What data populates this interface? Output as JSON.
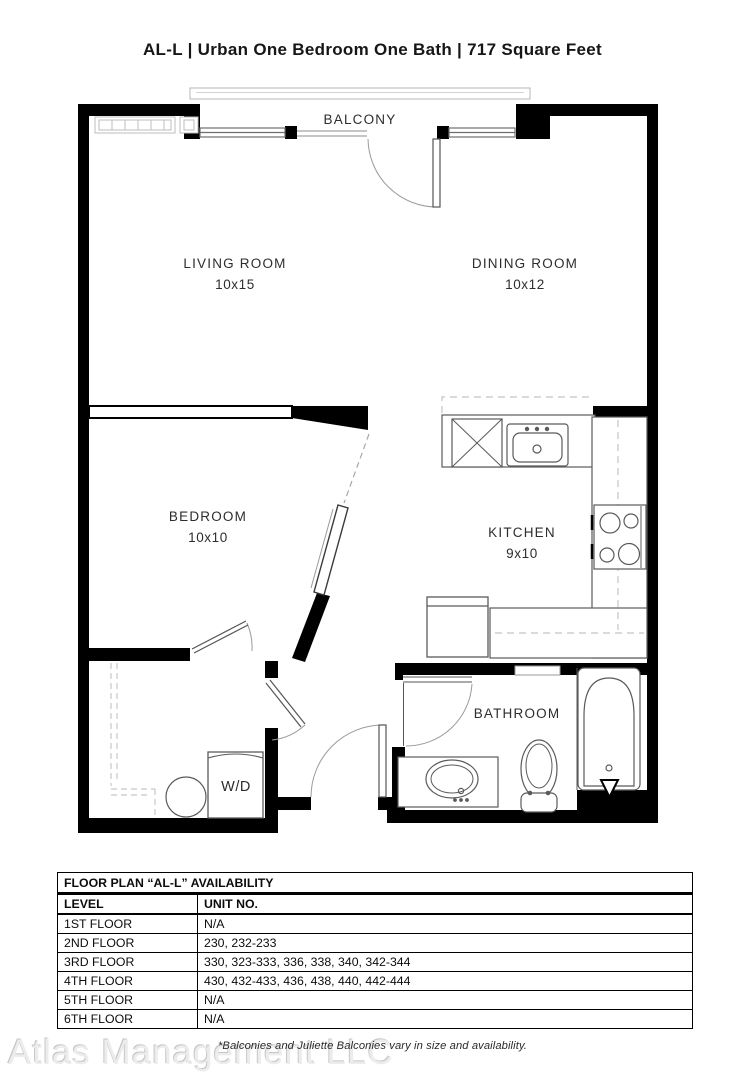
{
  "title": "AL-L | Urban One Bedroom One Bath | 717  Square Feet",
  "plan": {
    "balcony": "BALCONY",
    "living": {
      "name": "LIVING ROOM",
      "dims": "10x15"
    },
    "dining": {
      "name": "DINING ROOM",
      "dims": "10x12"
    },
    "bedroom": {
      "name": "BEDROOM",
      "dims": "10x10"
    },
    "kitchen": {
      "name": "KITCHEN",
      "dims": "9x10"
    },
    "bathroom": {
      "name": "BATHROOM"
    },
    "wd": "W/D"
  },
  "availability": {
    "title": "FLOOR PLAN “AL-L” AVAILABILITY",
    "columns": [
      "LEVEL",
      "UNIT NO."
    ],
    "rows": [
      [
        "1ST FLOOR",
        "N/A"
      ],
      [
        "2ND FLOOR",
        "230, 232-233"
      ],
      [
        "3RD FLOOR",
        "330, 323-333, 336, 338, 340, 342-344"
      ],
      [
        "4TH FLOOR",
        "430, 432-433, 436, 438, 440, 442-444"
      ],
      [
        "5TH FLOOR",
        "N/A"
      ],
      [
        "6TH FLOOR",
        "N/A"
      ]
    ]
  },
  "footnote": "*Balconies and Juliette Balconies vary in size and availability.",
  "watermark": "Atlas Management LLC",
  "colors": {
    "wall": "#000000",
    "fixture": "#5a5a5a",
    "dash": "#c4c4c4",
    "light": "#b5b5b5"
  }
}
